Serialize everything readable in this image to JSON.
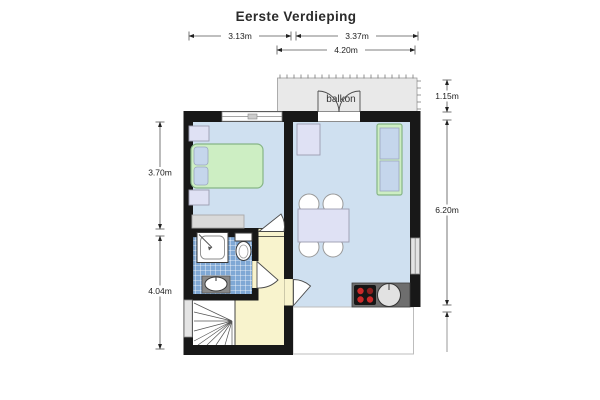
{
  "title": "Eerste Verdieping",
  "floor_plan": {
    "balcony_label": "balkon",
    "dimensions": {
      "top_left_width": "3.13m",
      "top_right_width": "3.37m",
      "balcony_width": "4.20m",
      "balcony_depth": "1.15m",
      "right_height": "6.20m",
      "bedroom_height": "3.70m",
      "lower_left_height": "4.04m"
    }
  },
  "colors": {
    "wall": "#181818",
    "room_floor": "#cfe0f0",
    "bathroom_tile": "#7fa8d5",
    "hallway_floor": "#f8f3cd",
    "furniture_green": "#cdeec3",
    "furniture_blue": "#c5d6ec",
    "furniture_lavender": "#dfe1f4",
    "balcony_gray": "#e9e9e9",
    "counter_gray": "#6e6e6e",
    "burner_red": "#cc2a2a"
  }
}
